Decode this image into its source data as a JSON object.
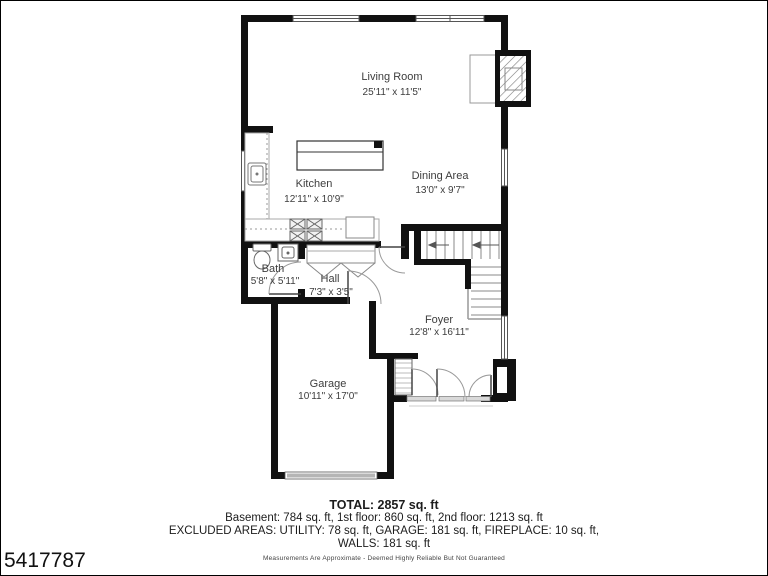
{
  "floor_plan": {
    "rooms": [
      {
        "name": "Living Room",
        "dims": "25'11\" x 11'5\""
      },
      {
        "name": "Kitchen",
        "dims": "12'11\" x 10'9\""
      },
      {
        "name": "Dining Area",
        "dims": "13'0\" x 9'7\""
      },
      {
        "name": "Bath",
        "dims": "5'8\" x 5'11\""
      },
      {
        "name": "Hall",
        "dims": "7'3\" x 3'5\""
      },
      {
        "name": "Foyer",
        "dims": "12'8\" x 16'11\""
      },
      {
        "name": "Garage",
        "dims": "10'11\" x 17'0\""
      }
    ]
  },
  "summary": {
    "total": "TOTAL: 2857 sq. ft",
    "floors": "Basement: 784 sq. ft, 1st floor: 860 sq. ft, 2nd floor: 1213 sq. ft",
    "excluded": "EXCLUDED AREAS: UTILITY: 78 sq. ft, GARAGE: 181 sq. ft, FIREPLACE: 10 sq. ft,",
    "walls": "WALLS: 181 sq. ft",
    "disclaimer": "Measurements Are Approximate - Deemed Highly Reliable But Not Guaranteed"
  },
  "listing_id": "5417787",
  "colors": {
    "wall": "#111111",
    "thin_line": "#999999",
    "text": "#3d3d3d"
  }
}
